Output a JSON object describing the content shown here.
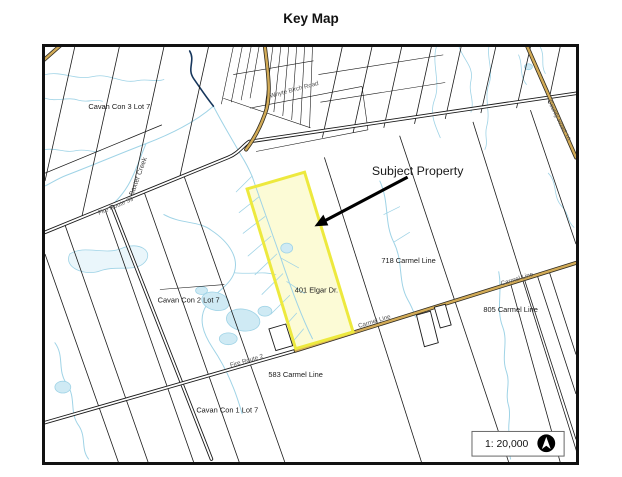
{
  "page": {
    "title": "Key Map"
  },
  "map": {
    "labels": {
      "con3": "Cavan Con 3 Lot 7",
      "con2": "Cavan Con 2 Lot 7",
      "con1": "Cavan Con 1 Lot 7",
      "carmel718": "718 Carmel Line",
      "carmel805": "805 Carmel Line",
      "carmel583": "583 Carmel Line",
      "elgar401": "401 Elgar Dr.",
      "subject": "Subject Property",
      "baxter_creek": "Baxter Creek"
    },
    "road_labels": {
      "fire_route_a": "Fire Route 39",
      "fire_route_b": "Fire Route 2",
      "whyte_birch": "Whyte Birch Road",
      "county_road": "County Road 10",
      "carmel_line_1": "Carmel Line",
      "carmel_line_2": "Carmel Line"
    },
    "scale": {
      "text": "1: 20,000"
    },
    "icons": {
      "north_arrow": "north-arrow-icon"
    },
    "colors": {
      "subject_fill": "#FBFACC",
      "subject_stroke": "#EDE93E",
      "creek": "#9FD3E6",
      "creek_dark": "#16365C",
      "road_tan": "#D2AB57",
      "line": "#1A1A1A"
    }
  }
}
